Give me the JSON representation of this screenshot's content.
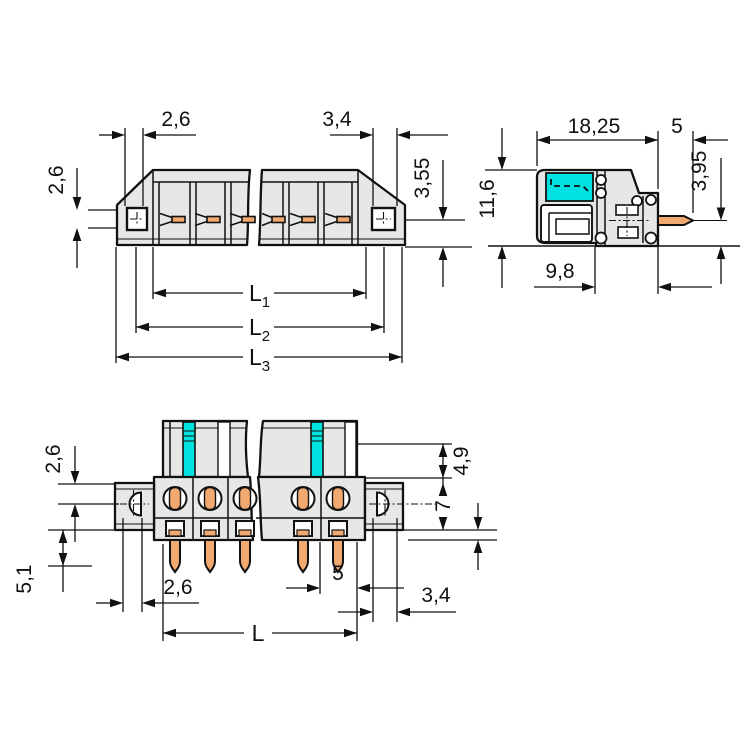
{
  "title": "connector-dimension-drawing",
  "colors": {
    "background": "#ffffff",
    "body_fill": "#e7e7e5",
    "outline": "#111111",
    "accent_cyan": "#00e1e1",
    "pin_orange": "#f1a96f"
  },
  "top": {
    "w_left": "2,6",
    "w_right": "3,4",
    "h_left": "2,6",
    "h_right": "3,55",
    "L1": "L",
    "L1s": "1",
    "L2": "L",
    "L2s": "2",
    "L3": "L",
    "L3s": "3"
  },
  "side": {
    "width": "18,25",
    "pin": "5",
    "pin_drop": "3,95",
    "height": "11,6",
    "depth": "9,8"
  },
  "front": {
    "left_top": "2,6",
    "left_bottom": "5,1",
    "hole_left": "2,6",
    "pitch": "5",
    "hole_right": "3,4",
    "length": "L",
    "right_top": "4,9",
    "flange": "7"
  }
}
